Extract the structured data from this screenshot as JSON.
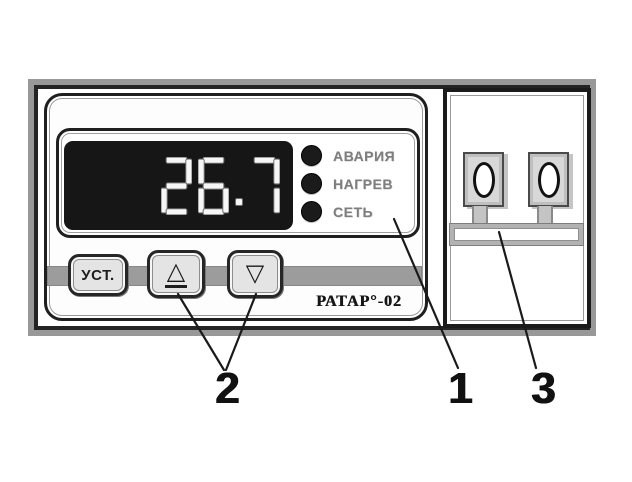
{
  "device": {
    "display": {
      "value": "26.7"
    },
    "indicators": [
      {
        "label": "АВАРИЯ"
      },
      {
        "label": "НАГРЕВ"
      },
      {
        "label": "СЕТЬ"
      }
    ],
    "buttons": {
      "set_label": "УСТ.",
      "up_glyph": "△",
      "down_glyph": "▽"
    },
    "brand": "РАТАР°-02"
  },
  "callouts": [
    {
      "number": "1"
    },
    {
      "number": "2"
    },
    {
      "number": "3"
    }
  ],
  "colors": {
    "lcd_background": "#161616",
    "lcd_digits": "#f6f6f6",
    "led": "#1b1b1b",
    "label_gray": "#7e7e7e",
    "frame_gray": "#989898",
    "line_black": "#1f1f1f"
  }
}
